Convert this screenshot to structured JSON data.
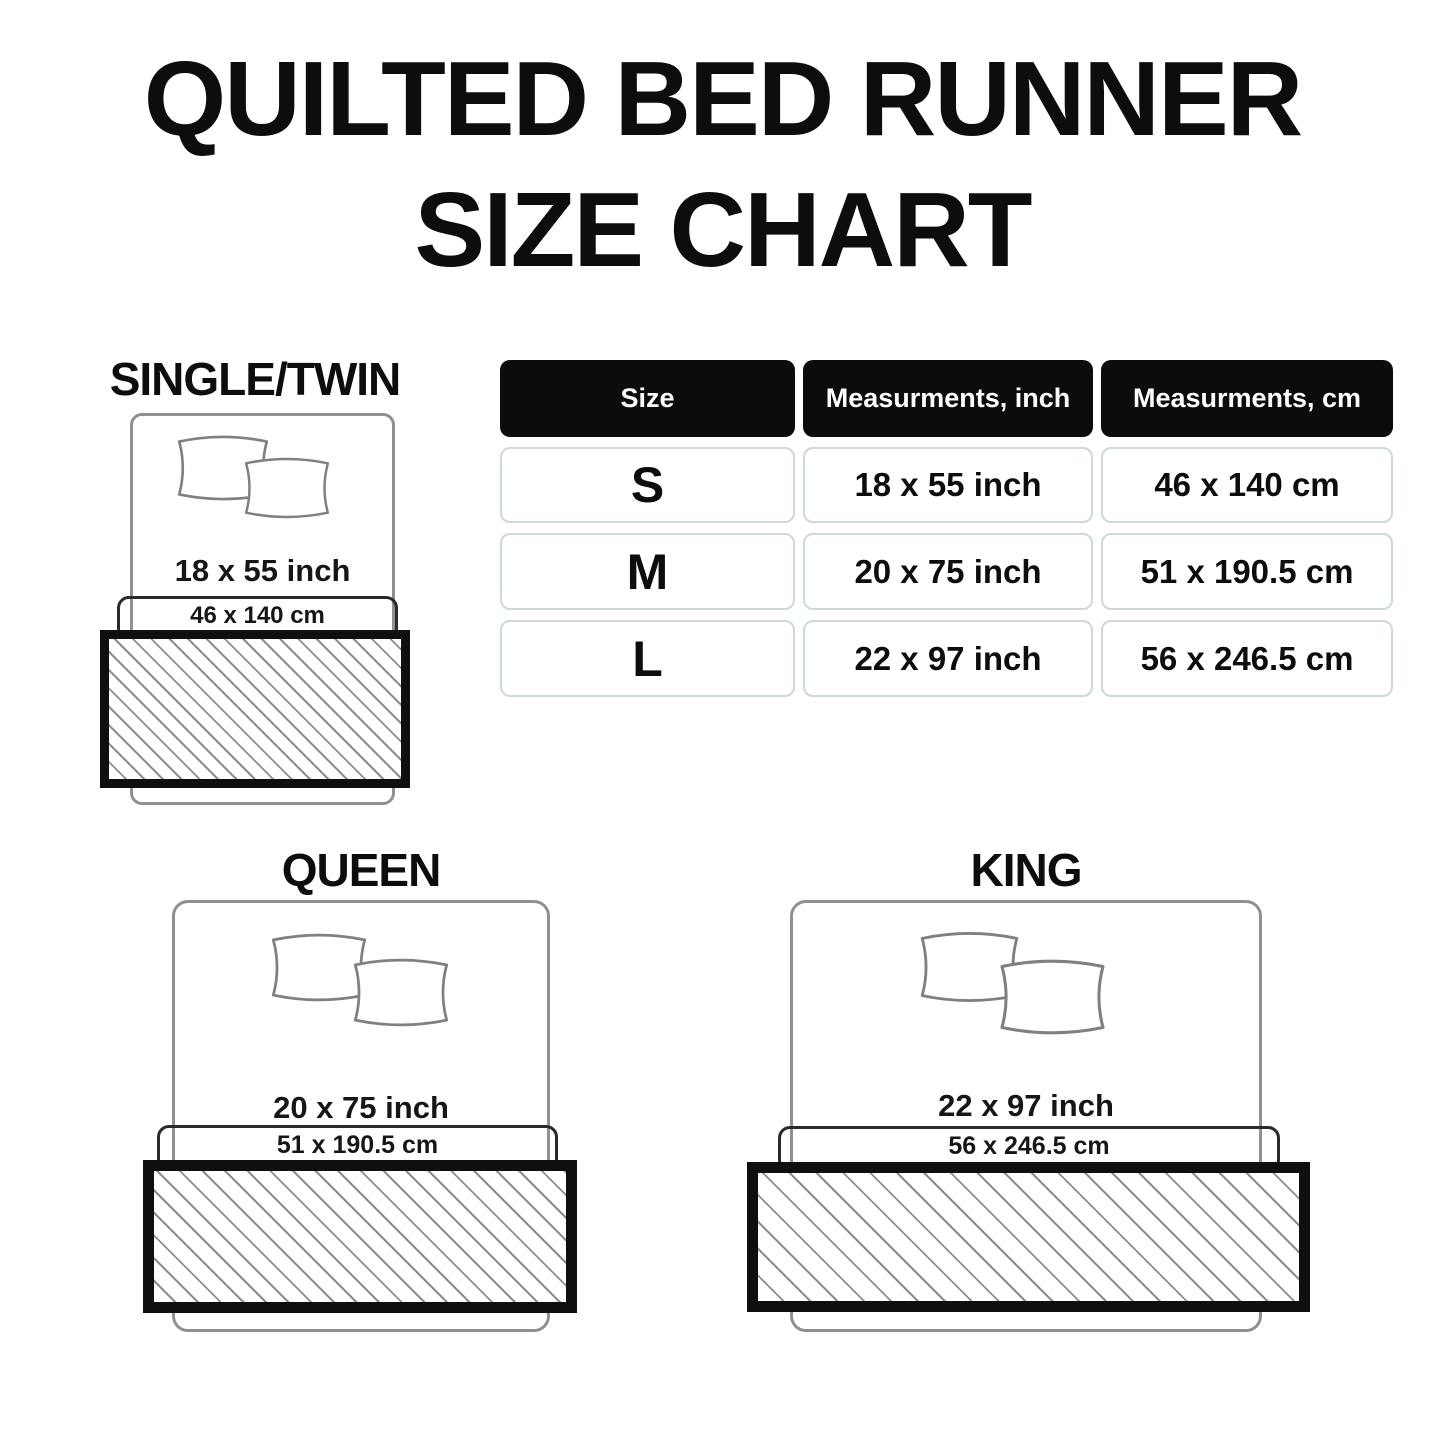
{
  "title": {
    "line1": "QUILTED BED RUNNER",
    "line2": "SIZE CHART"
  },
  "table": {
    "headers": [
      "Size",
      "Measurments, inch",
      "Measurments, cm"
    ],
    "rows": [
      {
        "size": "S",
        "inch": "18 x 55 inch",
        "cm": "46 x 140 cm"
      },
      {
        "size": "M",
        "inch": "20 x 75 inch",
        "cm": "51 x 190.5 cm"
      },
      {
        "size": "L",
        "inch": "22 x 97 inch",
        "cm": "56 x 246.5 cm"
      }
    ]
  },
  "diagrams": {
    "single": {
      "label": "SINGLE/TWIN",
      "inch": "18 x 55 inch",
      "cm": "46 x 140 cm"
    },
    "queen": {
      "label": "QUEEN",
      "inch": "20 x 75 inch",
      "cm": "51 x 190.5 cm"
    },
    "king": {
      "label": "KING",
      "inch": "22 x 97 inch",
      "cm": "56 x 246.5 cm"
    }
  },
  "colors": {
    "header_bg": "#0c0c0c",
    "cell_border": "#ccd9db",
    "hatch_line": "#8d8d8d",
    "bed_outline": "#909090",
    "runner_border": "#0f0f0f",
    "text": "#111111"
  }
}
